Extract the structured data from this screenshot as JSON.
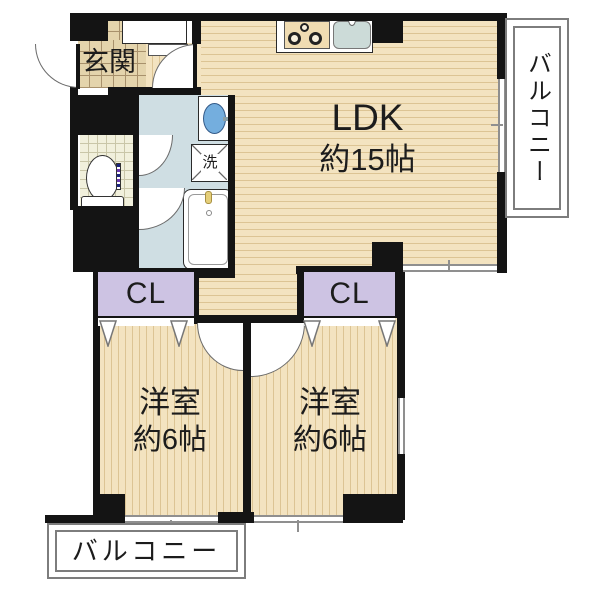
{
  "rooms": {
    "entrance": {
      "label": "玄関"
    },
    "ldk": {
      "label": "LDK",
      "size": "約15帖"
    },
    "bedroom_left": {
      "label": "洋室",
      "size": "約6帖"
    },
    "bedroom_right": {
      "label": "洋室",
      "size": "約6帖"
    },
    "closet_left": {
      "label": "CL"
    },
    "closet_right": {
      "label": "CL"
    },
    "laundry": {
      "label": "洗"
    },
    "balcony_right": {
      "label": "バルコニー"
    },
    "balcony_bottom": {
      "label": "バルコニー"
    }
  },
  "colors": {
    "wall": "#141414",
    "wood": "#f3e3c0",
    "wood_line": "#dcc494",
    "tile": "#e4d4ac",
    "tile_line": "#a8916c",
    "washroom": "#cfdee3",
    "toilet_tile": "#f1f0dc",
    "toilet_line": "#c9c6a8",
    "closet": "#cdc3e3",
    "window": "#8f8f8f",
    "balcony_border": "#7d7d7d",
    "text": "#1c1c1c"
  }
}
